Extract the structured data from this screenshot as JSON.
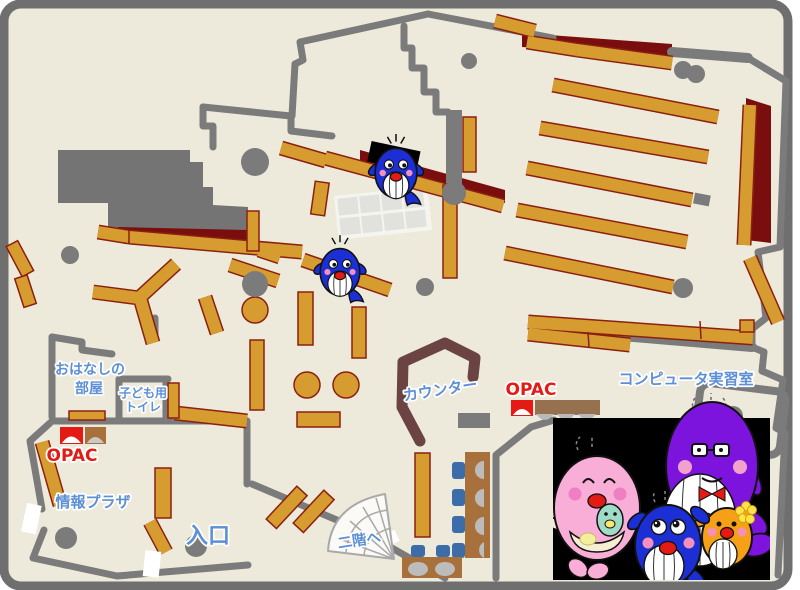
{
  "title": "library-floor-map",
  "labels": {
    "storytelling_room_line1": "おはなしの",
    "storytelling_room_line2": "部屋",
    "kids_toilet_line1": "子ども用",
    "kids_toilet_line2": "トイレ",
    "opac_left": "OPAC",
    "opac_center": "OPAC",
    "info_plaza": "情報プラザ",
    "entrance": "入口",
    "counter": "カウンター",
    "computer_room": "コンピュータ実習室",
    "stairs_up": "二階へ"
  },
  "colors": {
    "floor": "#edeadb",
    "frame_border": "#6f6f6f",
    "wall": "#7b7b7b",
    "shelf": "#d69c30",
    "shelf_border": "#8b2011",
    "back_wall_dark_red": "#7a0e0e",
    "counter_brown": "#6b4343",
    "label_blue": "#5c8fd6",
    "opac_red": "#e31b14",
    "chair_blue": "#3d6da8",
    "desk_brown": "#a8713c",
    "whale_blue": "#1c2fd4",
    "whale_pink": "#f8aed6",
    "whale_purple": "#7d14dd",
    "whale_orange": "#f5a017"
  },
  "characters": {
    "floor_mascots": [
      "blue-whale-mascot",
      "blue-whale-mascot"
    ],
    "family_picture": [
      "pink-whale-mother",
      "blue-whale-child",
      "purple-whale-father",
      "orange-whale-child"
    ]
  }
}
